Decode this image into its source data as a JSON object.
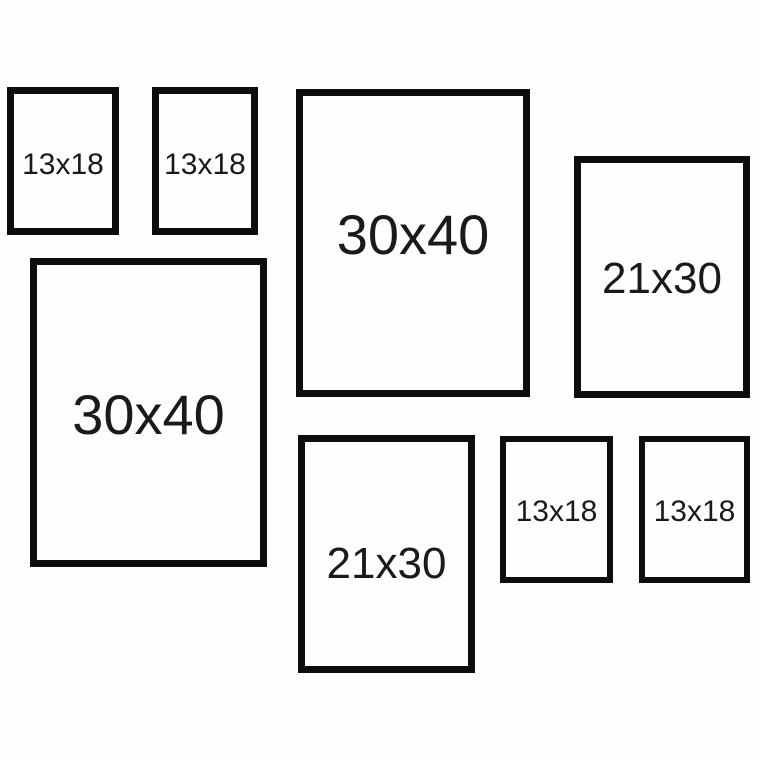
{
  "diagram": {
    "description": "photo-frame-set-size-diagram",
    "piece_count": 8
  },
  "colors": {
    "background": "#fefefe",
    "frame_border": "#0d0d0d",
    "label_text": "#1a1a1a"
  },
  "frames": [
    {
      "id": "top-left-13x18",
      "label": "13x18"
    },
    {
      "id": "top-second-13x18",
      "label": "13x18"
    },
    {
      "id": "center-top-30x40",
      "label": "30x40"
    },
    {
      "id": "right-21x30",
      "label": "21x30"
    },
    {
      "id": "left-large-30x40",
      "label": "30x40"
    },
    {
      "id": "bottom-center-21x30",
      "label": "21x30"
    },
    {
      "id": "bottom-right-13x18",
      "label": "13x18"
    },
    {
      "id": "bottom-far-right-13x18",
      "label": "13x18"
    }
  ]
}
